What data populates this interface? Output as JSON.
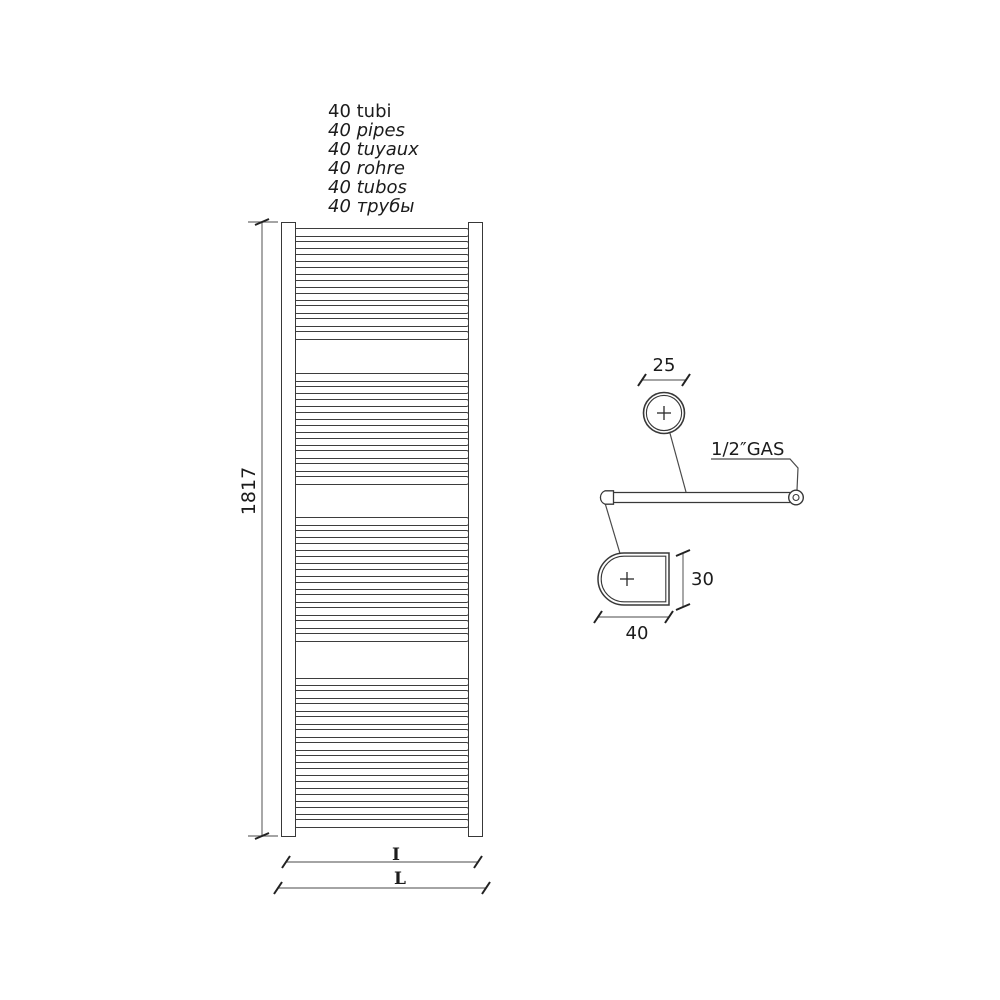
{
  "header": {
    "lines": [
      "40 tubi",
      "40 pipes",
      "40 tuyaux",
      "40 rohre",
      "40 tubos",
      "40 трубы"
    ]
  },
  "radiator": {
    "total_tubes": 40,
    "tube_groups": [
      9,
      9,
      10,
      12
    ]
  },
  "dimensions": {
    "overall_height": "1817",
    "tube_diameter": "25",
    "connection_thread": "1/2″GAS",
    "collector_depth": "30",
    "collector_width": "40",
    "interaxis_label": "I",
    "overall_width_label": "L"
  },
  "colors": {
    "ink": "#1c1c1c",
    "shape_line": "#383838",
    "dim_line": "#6e6e6e",
    "background": "#ffffff"
  }
}
